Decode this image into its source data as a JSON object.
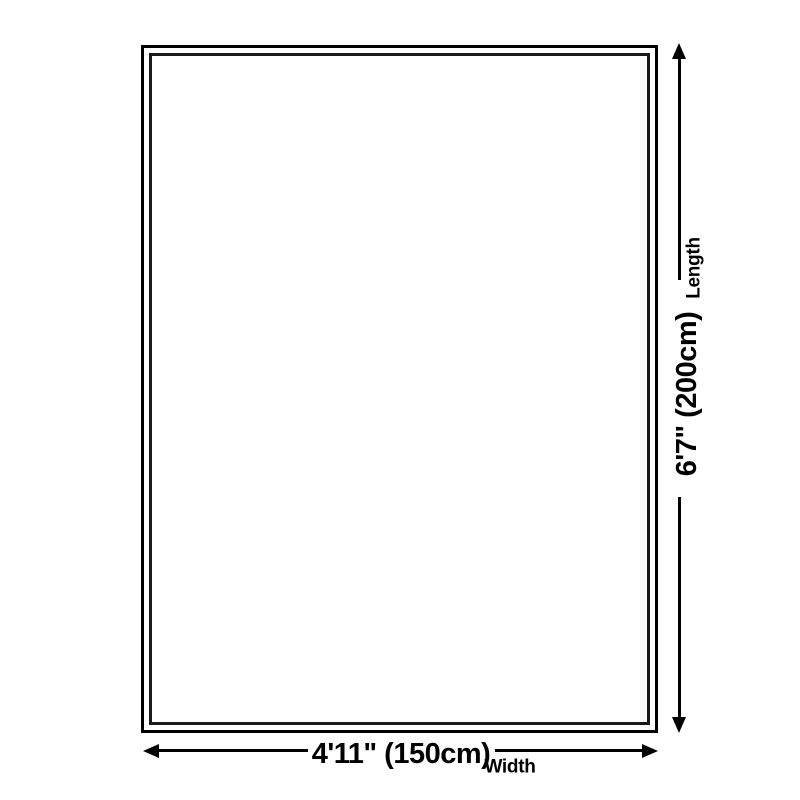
{
  "diagram": {
    "background_color": "#ffffff",
    "line_color": "#000000",
    "inner_line_color": "#1a1a1a",
    "rug_fill_color": "#ffffff",
    "length_dimension": {
      "value": "6'7\" (200cm)",
      "axis_label": "Length"
    },
    "width_dimension": {
      "value": "4'11\" (150cm)",
      "axis_label": "Width"
    }
  }
}
